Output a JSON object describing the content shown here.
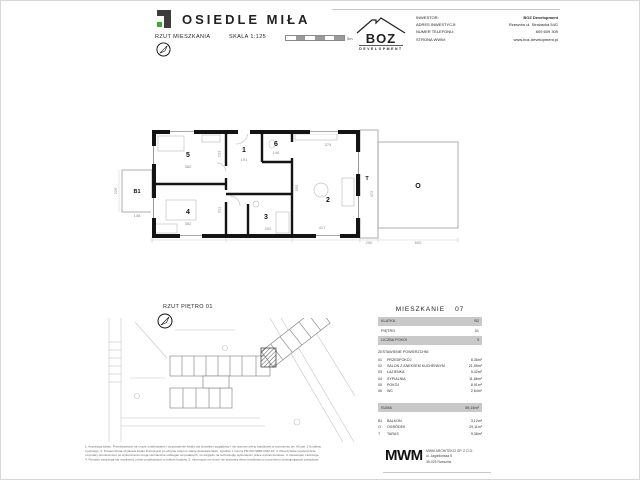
{
  "header": {
    "title": "OSIEDLE MIŁA",
    "plan_label": "RZUT MIESZKANIA",
    "scale_label": "SKALA 1:125",
    "scale_bar_unit": "5m",
    "brand_name": "BOZ",
    "brand_tagline": "DEVELOPMENT",
    "investor_rows": {
      "0": {
        "label": "INWESTOR:",
        "value": "BOZ Development"
      },
      "1": {
        "label": "ADRES INWESTYCJI:",
        "value": "Rzeszów ul. Strażacka 54G"
      },
      "2": {
        "label": "NUMER TELEFONU:",
        "value": "609 609 309"
      },
      "3": {
        "label": "STRONA WWW:",
        "value": "www.boz-development.pl"
      }
    }
  },
  "plan": {
    "room_labels": {
      "r1": "1",
      "r2": "2",
      "r3": "3",
      "r4": "4",
      "r5": "5",
      "r6": "6",
      "balcony": "B1",
      "terrace": "T",
      "garden": "O"
    },
    "dims": {
      "r5_w": "382",
      "r5_h": "233",
      "r4_w": "382",
      "r4_h": "311",
      "r1_w": "191",
      "r6_w": "146",
      "r2_w_top": "374",
      "r2_w": "417",
      "r2_h": "555",
      "r3_w": "202",
      "b1_w": "138",
      "b1_h": "226",
      "t_w": "200",
      "t_h": "472",
      "o_w": "600"
    }
  },
  "site": {
    "title": "RZUT PIĘTRO 01"
  },
  "apartment": {
    "title_label": "MIESZKANIE",
    "title_value": "07",
    "info_rows": {
      "0": {
        "label": "KLATKA",
        "value": "B2"
      },
      "1": {
        "label": "PIĘTRO",
        "value": "01"
      },
      "2": {
        "label": "LICZBA POKOI",
        "value": "3"
      }
    },
    "areas_heading": "ZESTAWIENIE POWIERZCHNI",
    "areas": {
      "0": {
        "no": "01",
        "name": "PRZEDPOKÓJ",
        "value": "8,36m²"
      },
      "1": {
        "no": "02",
        "name": "SALON Z ANEKSEM KUCHENNYM",
        "value": "21,95m²"
      },
      "2": {
        "no": "03",
        "name": "ŁAZIENKA",
        "value": "5,42m²"
      },
      "3": {
        "no": "04",
        "name": "SYPIALNIA",
        "value": "11,88m²"
      },
      "4": {
        "no": "05",
        "name": "POKÓJ",
        "value": "8,91m²"
      },
      "5": {
        "no": "06",
        "name": "WC",
        "value": "2,64m²"
      }
    },
    "sum_label": "SUMA",
    "sum_value": "59,16m²",
    "extras": {
      "0": {
        "no": "B1",
        "name": "BALKON",
        "value": "3,12m²"
      },
      "1": {
        "no": "O",
        "name": "OGRÓDEK",
        "value": "29,11m²"
      },
      "2": {
        "no": "T",
        "name": "TARAS",
        "value": "9,38m²"
      }
    }
  },
  "footer": {
    "disclaimer_lines": {
      "0": "1. Aranżacja lokalu. Przedstawione na rzucie umeblowanie i wyposażenie lokalu ma charakter poglądowy i nie stanowi oferty handlowej w rozumieniu art. 66 par. 1 Kodeksu",
      "1": "cywilnego. 2. Powierzchnia użytkowa lokalu liczona jest po obrysie ścian w stanie deweloperskim, zgodnie z normą PN-ISO 9836:2022-07. 3. Rzeczywiste powierzchnie",
      "2": "i wymiary pomieszczeń po wykończeniu mogą nieznacznie odbiegać od podanych, ze względu na technologię wykonania i prace wykończeniowe. 4. Deweloper zastrzega",
      "3": "4. Ponadto zastrzega się możliwość zmian projektowych w trakcie budowy. 5. Informacje na rzucie nie stanowią oferty handlowej w rozumieniu obowiązujących przepisów."
    },
    "architect_logo": "MWM",
    "architect_lines": {
      "0": "MWM ARCHITEKCI SP. Z O.O.",
      "1": "ul. Jagiellońska 5",
      "2": "35-025 Rzeszów"
    }
  },
  "colors": {
    "accent_green": "#3aaa35",
    "wall": "#141414",
    "table_row_gray": "#c9c9c9"
  }
}
